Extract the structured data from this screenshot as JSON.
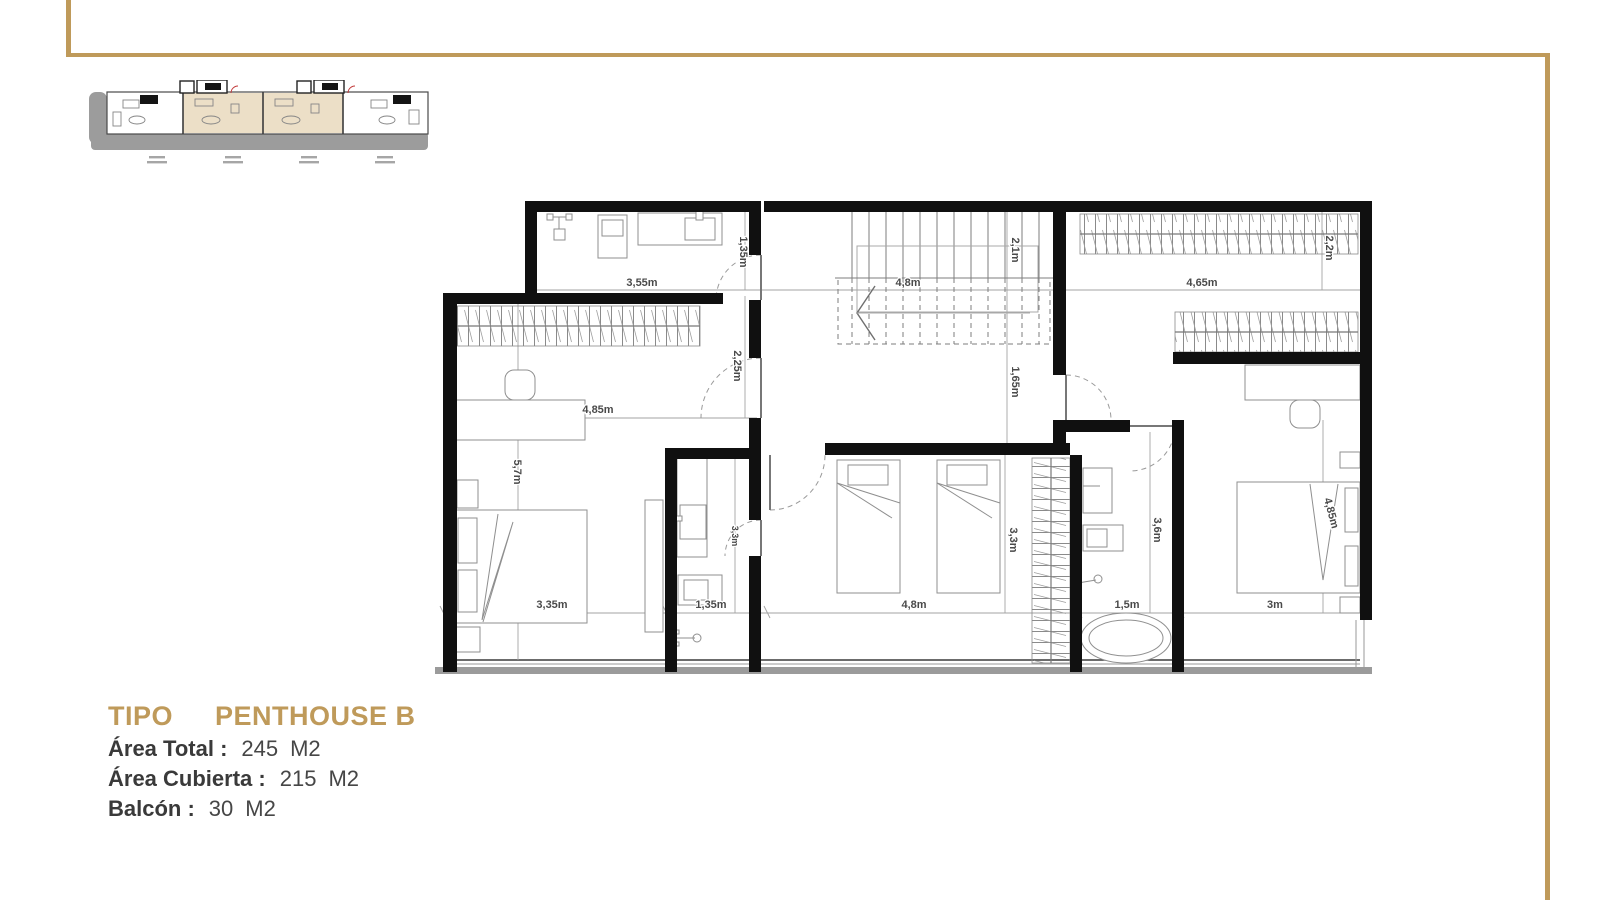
{
  "page": {
    "frame_color": "#BF9A5A",
    "background": "#FFFFFF"
  },
  "info": {
    "tipo_label": "TIPO",
    "tipo_value": "PENTHOUSE B",
    "rows": [
      {
        "label": "Área Total :",
        "value": "245",
        "unit": "M2"
      },
      {
        "label": "Área Cubierta :",
        "value": "215",
        "unit": "M2"
      },
      {
        "label": "Balcón :",
        "value": "30",
        "unit": "M2"
      }
    ]
  },
  "plan": {
    "dims": {
      "d355": "3,55m",
      "d135a": "1,35m",
      "d48_stairs": "4,8m",
      "d21": "2,1m",
      "d465": "4,65m",
      "d22": "2,2m",
      "d225": "2,25m",
      "d165": "1,65m",
      "d485_left": "4,85m",
      "d57": "5,7m",
      "d335": "3,35m",
      "d135b": "1,35m",
      "d33_bath": "3,3m",
      "d48_room": "4,8m",
      "d33_room": "3,3m",
      "d36": "3,6m",
      "d15": "1,5m",
      "d3": "3m",
      "d485_right": "4,85m"
    }
  }
}
